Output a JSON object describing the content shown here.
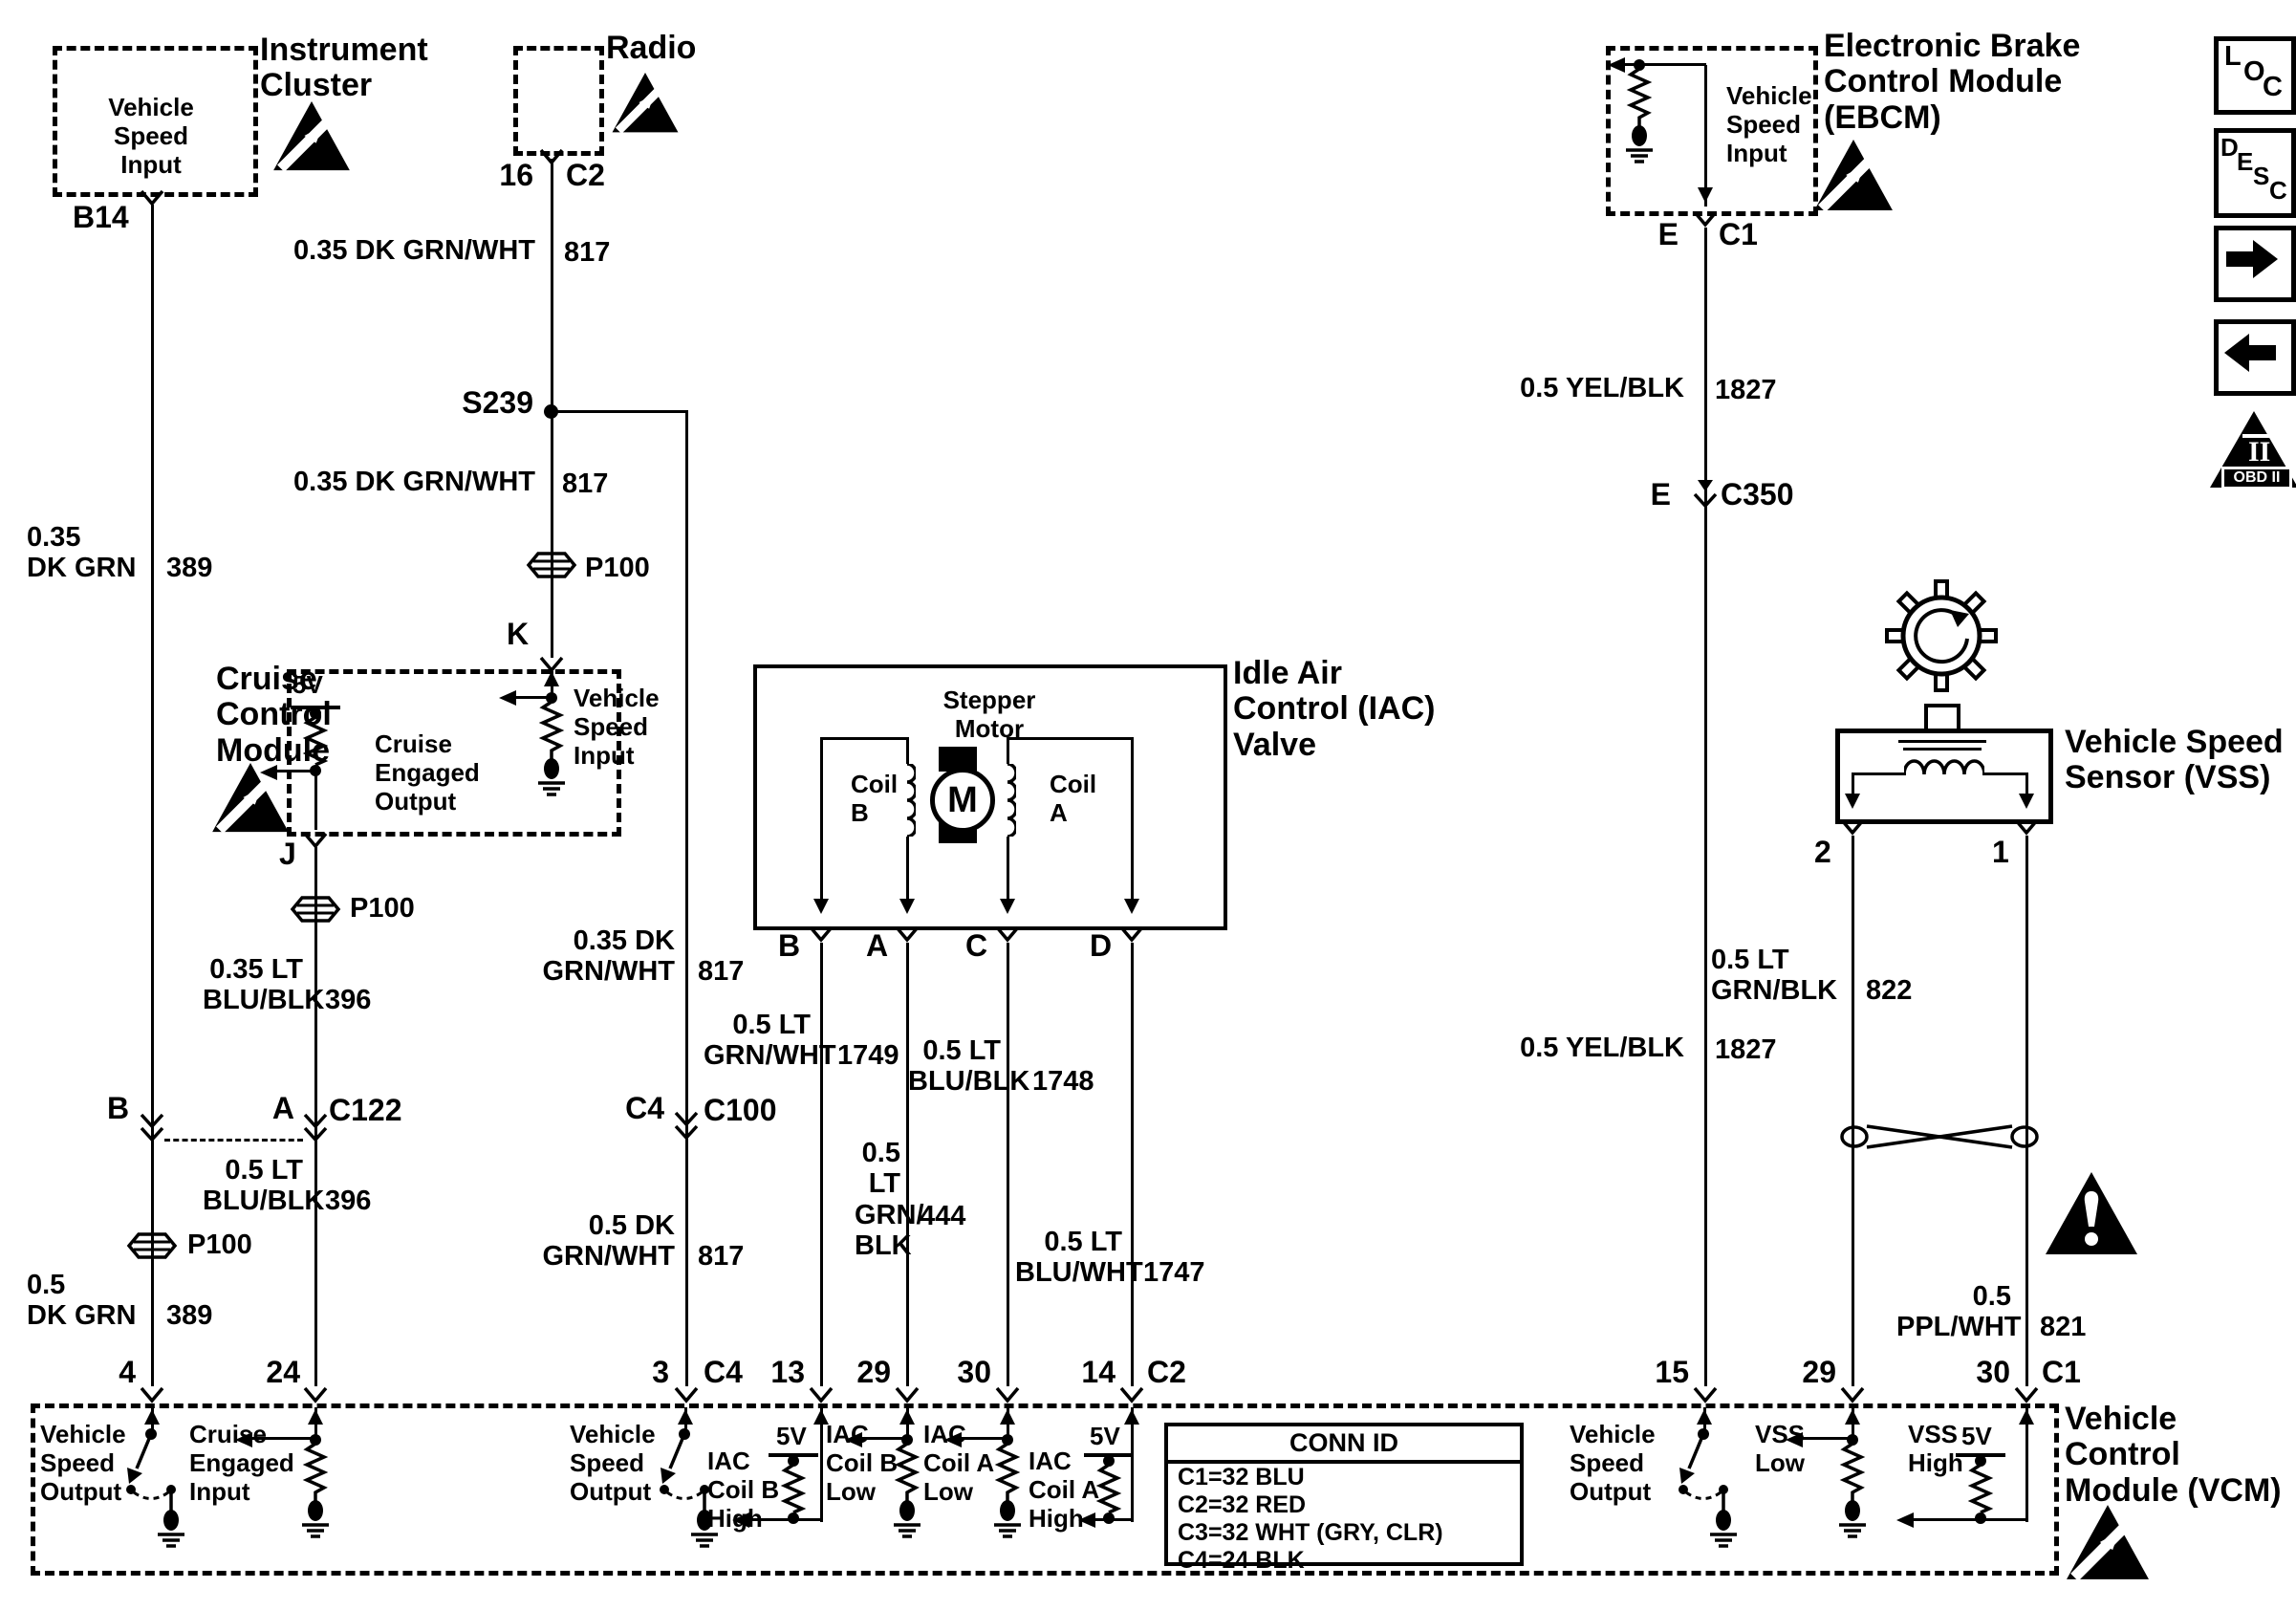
{
  "diagram": {
    "instrument_cluster": {
      "name": "Instrument\nCluster",
      "function": "Vehicle\nSpeed\nInput",
      "pin": "B14"
    },
    "radio": {
      "name": "Radio",
      "pin": "16",
      "conn": "C2"
    },
    "ebcm": {
      "name": "Electronic Brake\nControl Module\n(EBCM)",
      "function": "Vehicle\nSpeed\nInput",
      "pin": "E",
      "conn": "C1"
    },
    "cruise": {
      "name": "Cruise\nControl\nModule",
      "supply": "5V",
      "engaged_out": "Cruise\nEngaged\nOutput",
      "speed_in": "Vehicle\nSpeed\nInput",
      "pin": "J"
    },
    "iac": {
      "name": "Idle Air\nControl (IAC)\nValve",
      "stepper": "Stepper\nMotor",
      "motor": "M",
      "coil_b": "Coil\nB",
      "coil_a": "Coil\nA",
      "pins": [
        "B",
        "A",
        "C",
        "D"
      ]
    },
    "vss": {
      "name": "Vehicle Speed\nSensor (VSS)",
      "pin2": "2",
      "pin1": "1"
    },
    "vcm": {
      "name": "Vehicle\nControl\nModule (VCM)"
    }
  },
  "wires": {
    "dkgrnwht_817_a": {
      "name": "0.35 DK GRN/WHT",
      "num": "817"
    },
    "dkgrnwht_817_b": {
      "name": "0.35 DK GRN/WHT",
      "num": "817"
    },
    "dkgrnwht_817_c": {
      "name": "0.35 DK\nGRN/WHT",
      "num": "817"
    },
    "dkgrnwht_817_d": {
      "name": "0.5 DK\nGRN/WHT",
      "num": "817"
    },
    "dkgrn_389_a": {
      "name": "0.35\nDK GRN",
      "num": "389"
    },
    "dkgrn_389_b": {
      "name": "0.5\nDK GRN",
      "num": "389"
    },
    "ltblublk_396_a": {
      "name": "0.35 LT\nBLU/BLK",
      "num": "396"
    },
    "ltblublk_396_b": {
      "name": "0.5 LT\nBLU/BLK",
      "num": "396"
    },
    "ltgrnwht_1749": {
      "name": "0.5 LT\nGRN/WHT",
      "num": "1749"
    },
    "ltgrnblk_444": {
      "name": "0.5\nLT\nGRN/\nBLK",
      "num": "444"
    },
    "ltblublk_1748": {
      "name": "0.5 LT\nBLU/BLK",
      "num": "1748"
    },
    "ltbluwht_1747": {
      "name": "0.5 LT\nBLU/WHT",
      "num": "1747"
    },
    "yelblk_1827_a": {
      "name": "0.5 YEL/BLK",
      "num": "1827"
    },
    "yelblk_1827_b": {
      "name": "0.5 YEL/BLK",
      "num": "1827"
    },
    "ltgrnblk_822": {
      "name": "0.5 LT\nGRN/BLK",
      "num": "822"
    },
    "pplwht_821": {
      "name": "0.5\nPPL/WHT",
      "num": "821"
    }
  },
  "connectors": {
    "splice": "S239",
    "p100": "P100",
    "c122": {
      "pin_b": "B",
      "pin_a": "A",
      "name": "C122"
    },
    "c100": {
      "pin": "C4",
      "name": "C100"
    },
    "c350": {
      "pin": "E",
      "name": "C350"
    },
    "cruise_pin_k": "K"
  },
  "vcm_pins": {
    "p4": {
      "pin": "4",
      "label": "Vehicle\nSpeed\nOutput"
    },
    "p24": {
      "pin": "24",
      "label": "Cruise\nEngaged\nInput"
    },
    "p3": {
      "pin": "3",
      "conn": "C4",
      "label": "Vehicle\nSpeed\nOutput"
    },
    "p13": {
      "pin": "13",
      "supply": "5V",
      "label": "IAC\nCoil B\nHigh"
    },
    "p29c2": {
      "pin": "29",
      "label": "IAC\nCoil B\nLow"
    },
    "p30c2": {
      "pin": "30",
      "label": "IAC\nCoil A\nLow"
    },
    "p14": {
      "pin": "14",
      "conn": "C2",
      "supply": "5V",
      "label": "IAC\nCoil A\nHigh"
    },
    "p15": {
      "pin": "15",
      "label": "Vehicle\nSpeed\nOutput"
    },
    "p29c1": {
      "pin": "29",
      "label": "VSS\nLow"
    },
    "p30c1": {
      "pin": "30",
      "conn": "C1",
      "supply": "5V",
      "label": "VSS\nHigh"
    }
  },
  "conn_id": {
    "title": "CONN ID",
    "rows": [
      "C1=32 BLU",
      "C2=32 RED",
      "C3=32 WHT (GRY, CLR)",
      "C4=24 BLK"
    ]
  },
  "legend": {
    "loc": [
      "L",
      "O",
      "C"
    ],
    "desc": [
      "D",
      "E",
      "S",
      "C"
    ],
    "obd_label": "OBD II",
    "obd_numeral": "II"
  }
}
